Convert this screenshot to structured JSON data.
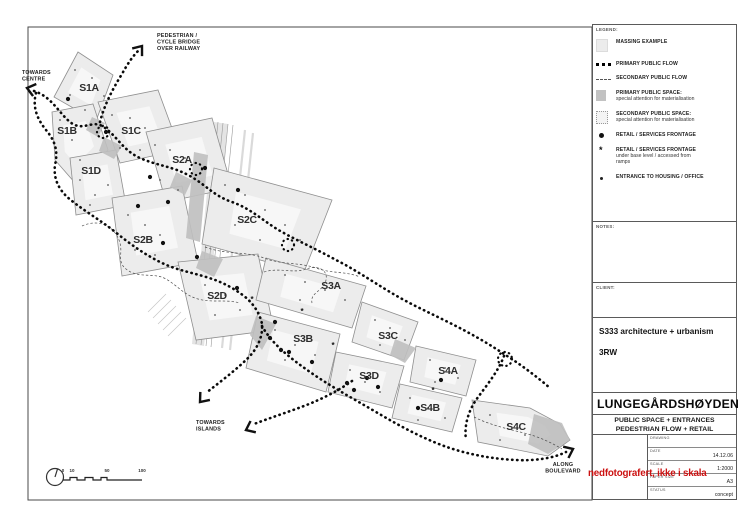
{
  "colors": {
    "stamp_red": "#cc1111",
    "massing_gray": "#ececec",
    "primary_space_gray": "#bfbfbf",
    "flow_black": "#0a0a0a"
  },
  "stamp": {
    "text": "nedfotografert, ikke i skala"
  },
  "sidebar": {
    "legend_label": "LEGEND:",
    "legend_items": [
      {
        "icon": "massing-square",
        "label": "MASSING EXAMPLE",
        "sub": []
      },
      {
        "icon": "primary-flow-line",
        "label": "PRIMARY PUBLIC FLOW",
        "sub": []
      },
      {
        "icon": "secondary-flow-line",
        "label": "SECONDARY PUBLIC FLOW",
        "sub": []
      },
      {
        "icon": "primary-space-square",
        "label": "PRIMARY PUBLIC SPACE:",
        "sub": [
          "special attention for materialisation"
        ]
      },
      {
        "icon": "secondary-space-square",
        "label": "SECONDARY PUBLIC SPACE:",
        "sub": [
          "special attention for materialisation"
        ]
      },
      {
        "icon": "retail-dot",
        "label": "RETAIL / SERVICES FRONTAGE",
        "sub": []
      },
      {
        "icon": "retail-asterisk",
        "label": "RETAIL / SERVICES FRONTAGE",
        "sub": [
          "under base level / accessed from",
          "ramps"
        ]
      },
      {
        "icon": "entrance-dot",
        "label": "ENTRANCE  TO HOUSING /  OFFICE",
        "sub": []
      }
    ],
    "notes_label": "NOTES:",
    "client_label": "CLIENT:",
    "firm_line1": "S333 architecture + urbanism",
    "firm_line2": "3RW",
    "project_title": "LUNGEGÅRDSHØYDEN",
    "subtitle_line1": "PUBLIC SPACE + ENTRANCES",
    "subtitle_line2": "PEDESTRIAN FLOW + RETAIL",
    "fields": [
      {
        "label": "DRAWING",
        "value": ""
      },
      {
        "label": "DATE",
        "value": "14.12.06"
      },
      {
        "label": "SCALE",
        "value": "1:2000"
      },
      {
        "label": "PAPER SIZE",
        "value": "A3"
      },
      {
        "label": "STATUS",
        "value": "concept"
      }
    ]
  },
  "map": {
    "parcels": [
      {
        "id": "S1A",
        "points": "78,52 113,75 96,121 54,97",
        "label_x": 89,
        "label_y": 91
      },
      {
        "id": "S1B",
        "points": "52,112 93,104 108,150 76,184 55,160",
        "label_x": 67,
        "label_y": 134
      },
      {
        "id": "S1C",
        "points": "98,102 158,90 180,150 120,163",
        "label_x": 131,
        "label_y": 134
      },
      {
        "id": "S1D",
        "points": "70,158 116,150 126,205 76,215",
        "label_x": 91,
        "label_y": 174
      },
      {
        "id": "S2A",
        "points": "146,132 212,118 232,188 166,202",
        "label_x": 182,
        "label_y": 163
      },
      {
        "id": "S2B",
        "points": "112,198 182,186 198,262 122,276",
        "label_x": 143,
        "label_y": 243
      },
      {
        "id": "S2C",
        "points": "214,168 332,200 304,272 202,244",
        "label_x": 247,
        "label_y": 223
      },
      {
        "id": "S2D",
        "points": "178,262 258,254 274,330 196,340",
        "label_x": 217,
        "label_y": 299
      },
      {
        "id": "S3A",
        "points": "266,258 366,286 352,328 256,300",
        "label_x": 331,
        "label_y": 289
      },
      {
        "id": "S3B",
        "points": "258,312 340,334 326,392 246,368",
        "label_x": 303,
        "label_y": 342
      },
      {
        "id": "S3C",
        "points": "362,302 418,322 404,360 352,342",
        "label_x": 388,
        "label_y": 339
      },
      {
        "id": "S3D",
        "points": "336,352 404,366 392,408 328,392",
        "label_x": 369,
        "label_y": 379
      },
      {
        "id": "S4A",
        "points": "416,346 476,360 466,396 410,382",
        "label_x": 448,
        "label_y": 374
      },
      {
        "id": "S4B",
        "points": "400,384 462,398 452,432 392,418",
        "label_x": 430,
        "label_y": 411
      },
      {
        "id": "S4C",
        "points": "472,400 530,408 560,424 570,440 548,456 478,442",
        "label_x": 516,
        "label_y": 430
      }
    ],
    "dark_patches": [
      "92,117 105,123 98,137 86,130",
      "104,137 122,146 114,159 99,151",
      "194,152 208,155 200,242 186,238",
      "176,172 192,180 185,195 170,187",
      "202,251 223,259 214,277 196,268",
      "256,316 276,324 262,350 250,335",
      "395,339 416,348 405,363 390,355",
      "534,414 562,423 570,440 548,454 528,444"
    ],
    "railway_bands": [
      "214,122 228,124 204,346 192,344"
    ],
    "railway_lines": [
      [
        218,
        122,
        196,
        344
      ],
      [
        223,
        123,
        201,
        345
      ],
      [
        228,
        124,
        206,
        346
      ],
      [
        233,
        125,
        211,
        347
      ]
    ],
    "faint_lines": [
      [
        245,
        130,
        222,
        348
      ],
      [
        253,
        133,
        230,
        350
      ]
    ],
    "hatch_lines": [
      [
        148,
        312,
        166,
        294
      ],
      [
        153,
        318,
        171,
        300
      ],
      [
        158,
        324,
        176,
        306
      ],
      [
        163,
        330,
        181,
        312
      ],
      [
        168,
        336,
        186,
        318
      ]
    ],
    "primary_flows": [
      "M34,91 C52,97 58,112 70,122 C82,132 92,120 102,126 C116,134 122,150 140,158 C158,166 172,166 190,176 C206,185 214,196 232,202 C252,209 264,222 282,232 C300,242 318,250 336,260 C354,269 370,280 390,292 C408,303 428,312 448,322 C468,332 486,342 504,354 C520,364 536,376 550,388",
      "M100,122 C104,106 112,90 122,74 C128,63 133,56 139,50",
      "M36,93 C32,108 38,120 46,130 C56,142 58,152 55,165 C53,180 60,192 72,201 C86,212 100,220 114,231 C130,244 144,254 160,262 C176,270 190,272 206,277 C220,281 232,287 244,296 C254,304 260,314 262,324 C263,336 258,348 248,358 C236,370 220,382 206,393",
      "M352,381 C338,391 322,399 304,406 C288,412 270,418 254,424",
      "M262,326 C272,344 290,358 310,372 C330,386 352,398 376,412 C398,425 420,437 444,446 C466,454 492,459 516,460 C536,461 554,458 566,452",
      "M504,356 C498,372 486,386 476,400 C468,412 464,426 466,440"
    ],
    "loops": [
      [
        103,
        132,
        6
      ],
      [
        196,
        169,
        6
      ],
      [
        288,
        245,
        6
      ],
      [
        505,
        359,
        7
      ]
    ],
    "arrows": [
      [
        27,
        88,
        195
      ],
      [
        142,
        46,
        -52
      ],
      [
        200,
        402,
        130
      ],
      [
        246,
        430,
        155
      ],
      [
        573,
        449,
        -25
      ]
    ],
    "secondary_flows": [
      "M82,226 C100,218 114,227 119,240 C124,252 116,261 126,269 C138,279 154,272 166,279 C178,286 184,295 198,299 C212,303 226,299 240,303",
      "M205,247 C226,255 246,251 264,258 C282,265 298,262 316,268 C332,274 346,271 360,277",
      "M264,272 C280,267 294,274 306,269 C320,264 330,272 325,283 C321,292 310,293 312,303",
      "M474,417 C490,425 508,429 524,433 C540,437 552,443 562,449"
    ],
    "retail_dots": [
      68,
      99,
      106,
      132,
      150,
      177,
      138,
      206,
      168,
      202,
      163,
      243,
      197,
      257,
      205,
      168,
      238,
      190,
      237,
      288,
      275,
      322,
      270,
      338,
      281,
      350,
      289,
      352,
      312,
      362,
      347,
      383,
      354,
      390,
      367,
      378,
      378,
      387,
      418,
      408,
      441,
      380
    ],
    "retail_under_markers": [
      [
        252,
        302
      ],
      [
        302,
        314
      ],
      [
        333,
        348
      ],
      [
        433,
        393
      ]
    ],
    "entrance_dots": [
      75,
      70,
      92,
      78,
      104,
      96,
      70,
      95,
      85,
      110,
      60,
      120,
      72,
      140,
      80,
      160,
      112,
      115,
      130,
      118,
      145,
      128,
      120,
      148,
      140,
      150,
      80,
      180,
      95,
      195,
      108,
      185,
      90,
      205,
      155,
      145,
      170,
      150,
      185,
      158,
      160,
      180,
      178,
      190,
      128,
      215,
      145,
      225,
      160,
      235,
      135,
      250,
      155,
      255,
      225,
      185,
      245,
      195,
      265,
      210,
      285,
      225,
      235,
      225,
      260,
      240,
      300,
      240,
      205,
      285,
      225,
      295,
      240,
      310,
      215,
      315,
      285,
      275,
      305,
      282,
      325,
      290,
      345,
      300,
      300,
      300,
      275,
      330,
      295,
      345,
      315,
      355,
      285,
      360,
      375,
      320,
      390,
      328,
      405,
      340,
      380,
      345,
      350,
      370,
      365,
      382,
      380,
      392,
      430,
      360,
      445,
      368,
      458,
      378,
      435,
      382,
      410,
      398,
      428,
      408,
      445,
      418,
      418,
      420,
      490,
      415,
      508,
      425,
      525,
      435,
      500,
      440
    ],
    "annotations": [
      {
        "name": "towards-centre-label",
        "lines": [
          "TOWARDS",
          "CENTRE"
        ],
        "x": 22,
        "y": 74,
        "anchor": "start"
      },
      {
        "name": "bridge-label",
        "lines": [
          "PEDESTRIAN /",
          "CYCLE BRIDGE",
          "OVER RAILWAY"
        ],
        "x": 157,
        "y": 37,
        "anchor": "start"
      },
      {
        "name": "towards-islands-label",
        "lines": [
          "TOWARDS",
          "ISLANDS"
        ],
        "x": 196,
        "y": 424,
        "anchor": "start"
      },
      {
        "name": "along-boulevard-label",
        "lines": [
          "ALONG",
          "BOULEVARD"
        ],
        "x": 563,
        "y": 466,
        "anchor": "middle"
      }
    ],
    "scale_bar": {
      "labels": [
        "0",
        "10",
        "50",
        "100"
      ],
      "label_x": [
        63,
        72,
        107,
        142
      ]
    }
  }
}
